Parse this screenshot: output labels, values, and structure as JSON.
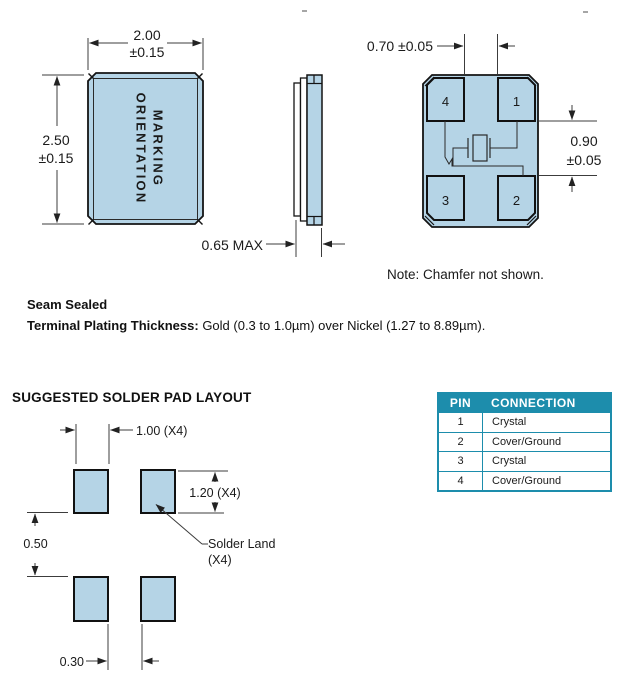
{
  "colors": {
    "package_fill": "#b5d4e6",
    "outline": "#1a1a1a",
    "dim_line": "#3c3c3c",
    "table_accent": "#1d8dac"
  },
  "top_drawing": {
    "front_view": {
      "marking_line1": "MARKING",
      "marking_line2": "ORIENTATION",
      "width_value": "2.00",
      "width_tol": "±0.15",
      "height_value": "2.50",
      "height_tol": "±0.15"
    },
    "side_view": {
      "thickness": "0.65 MAX"
    },
    "bottom_view": {
      "pad_gap": "0.70 ±0.05",
      "row_gap_value": "0.90",
      "row_gap_tol": "±0.05",
      "pad_labels": [
        "4",
        "1",
        "3",
        "2"
      ]
    },
    "note": "Note: Chamfer not shown."
  },
  "notes": {
    "seam": "Seam Sealed",
    "plating_label": "Terminal Plating Thickness:",
    "plating_value": " Gold (0.3 to 1.0µm) over Nickel (1.27 to 8.89µm)."
  },
  "solder_pad_layout": {
    "title": "SUGGESTED SOLDER PAD LAYOUT",
    "pad_width": "1.00 (X4)",
    "pad_height": "1.20 (X4)",
    "row_gap": "0.50",
    "col_gap": "0.30",
    "land_line1": "Solder Land",
    "land_line2": "(X4)"
  },
  "pin_table": {
    "headers": [
      "PIN",
      "CONNECTION"
    ],
    "rows": [
      [
        "1",
        "Crystal"
      ],
      [
        "2",
        "Cover/Ground"
      ],
      [
        "3",
        "Crystal"
      ],
      [
        "4",
        "Cover/Ground"
      ]
    ]
  }
}
